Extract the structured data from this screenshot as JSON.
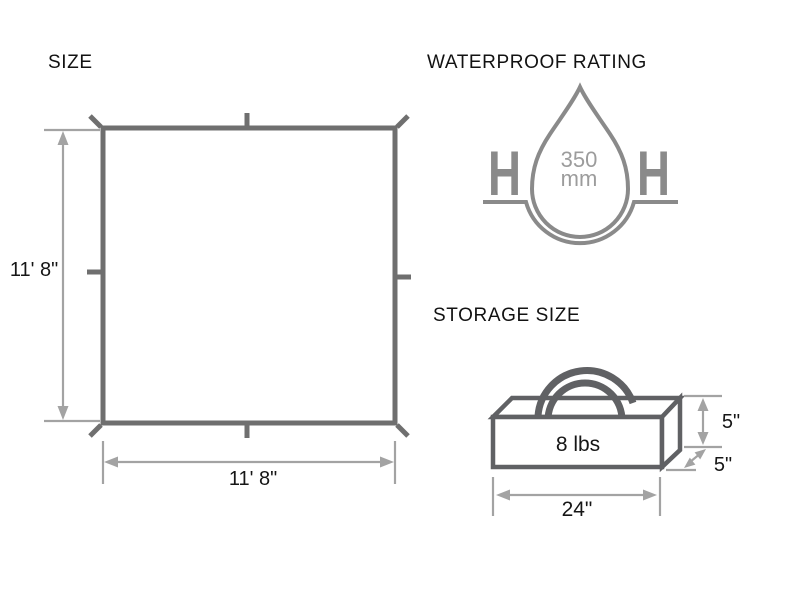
{
  "colors": {
    "text": "#161616",
    "tarp_stroke": "#6f6f6f",
    "dimension": "#a3a3a3",
    "waterproof_stroke": "#8a8a8a",
    "waterproof_text": "#9c9c9c",
    "box_stroke": "#606164"
  },
  "size_section": {
    "title": "SIZE",
    "height_label": "11' 8\"",
    "width_label": "11' 8\""
  },
  "waterproof_section": {
    "title": "WATERPROOF RATING",
    "rating_value": "350",
    "rating_unit": "mm",
    "left_symbol": "H",
    "right_symbol": "H"
  },
  "storage_section": {
    "title": "STORAGE SIZE",
    "weight_label": "8 lbs",
    "height_label": "5\"",
    "depth_label": "5\"",
    "width_label": "24\""
  }
}
